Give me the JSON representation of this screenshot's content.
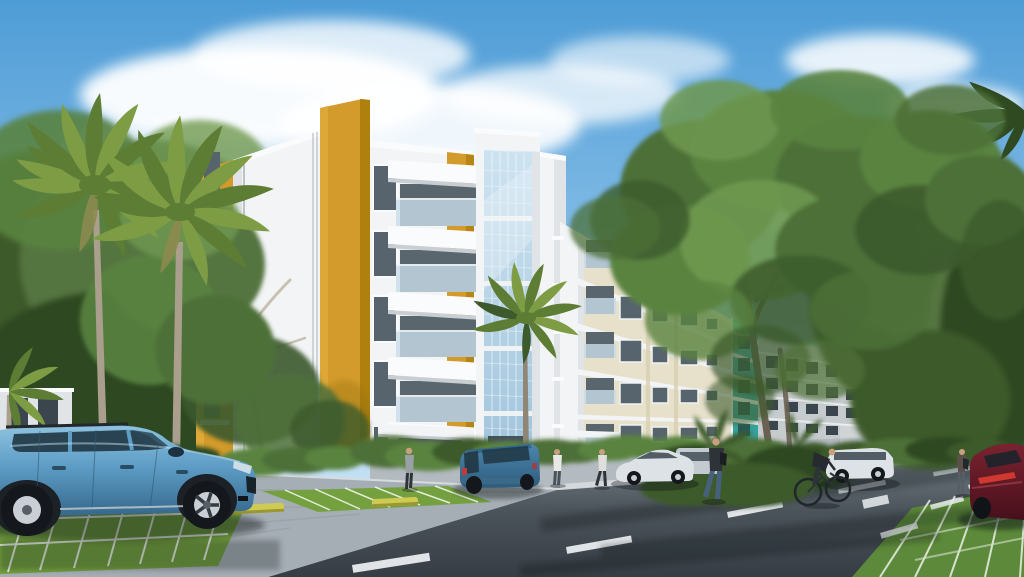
{
  "scene": {
    "type": "architectural-exterior-rendering",
    "description": "Sunny 3D rendering of a modern five-storey apartment complex: mustard-yellow, white and teal facades with balconies and a glass stair tower, palm trees and shade trees, grass-paver parking bays with a light-blue SUV in the foreground, a street with lane markings, parked cars, pedestrians and a cyclist",
    "objects": [
      "sky with clouds",
      "apartment building mustard and white",
      "glass stair tower",
      "balconies with glass railings",
      "cream apartment building",
      "teal accent tower",
      "distant grey building",
      "palm trees",
      "shade trees",
      "hedges",
      "grass paver parking bays",
      "yellow wheel stops",
      "asphalt street",
      "white lane markings",
      "light-blue SUV",
      "compact blue SUV",
      "white sedan",
      "silver SUV",
      "white station wagon",
      "dark-red car",
      "pedestrians",
      "cyclist"
    ]
  },
  "colors": {
    "sky_top": "#4e9cd6",
    "sky_mid": "#8cc2e9",
    "sky_low": "#c6e2f4",
    "cloud": "#ffffff",
    "mustard": "#d39b2b",
    "mustard_light": "#e2ae3e",
    "mustard_dark": "#b0800f",
    "white_wall": "#f2f4f5",
    "white_bright": "#fafbfc",
    "white_shade": "#e0e4e7",
    "grey_shade": "#c9ced2",
    "wall_recess": "#5a666e",
    "window_glass": "#57646d",
    "window_dark": "#3a454d",
    "glass_light": "#cde3f1",
    "glass_mid": "#a0c4dc",
    "mullion": "#f2f5f7",
    "railing_glass": "#c8ddea",
    "cream": "#e7e0cb",
    "cream_dark": "#d9d0b4",
    "teal": "#59c6bf",
    "teal_dark": "#2f9e99",
    "bldg_grey": "#c6cbce",
    "bldg_far": "#b4bdc1",
    "foliage_deep": "#2f4a20",
    "foliage_dark": "#3c5a2c",
    "foliage": "#4e7038",
    "foliage_mid": "#5a8340",
    "foliage_light": "#6f9850",
    "foliage_olive": "#557540",
    "palm_green": "#7e9c43",
    "palm_dark": "#5d7c34",
    "palm_trunk": "#a99f8c",
    "branch_pale": "#c6bead",
    "trunk": "#6a6152",
    "grass": "#74a040",
    "grass_dark": "#5d8a3a",
    "road_far": "#747e86",
    "road": "#4c545b",
    "road_dark": "#363d44",
    "pavement": "#a6aeb5",
    "pavement_line": "#6e767d",
    "sidewalk": "#b3bac0",
    "curb": "#d7dbde",
    "marking": "#e9edf0",
    "wheel_stop": "#cfcb52",
    "suv_blue": "#5e9dc6",
    "suv_blue_light": "#8fc3e0",
    "suv_blue_dark": "#35678a",
    "window_tint": "#203642",
    "car_blue": "#4c86ad",
    "car_blue_dark": "#2e5c7c",
    "car_white": "#dde2e6",
    "car_silver": "#c3cad0",
    "car_red": "#7a2330",
    "car_red_dark": "#47101b",
    "taillight": "#d43a30",
    "tire": "#14181c",
    "rim": "#c9cfd4",
    "shadow": "#0c1218",
    "skin": "#c9a07e",
    "person_dark": "#2e3338",
    "person_grey": "#9aa1a6",
    "person_white": "#e8e8e6",
    "jeans": "#47617c"
  }
}
